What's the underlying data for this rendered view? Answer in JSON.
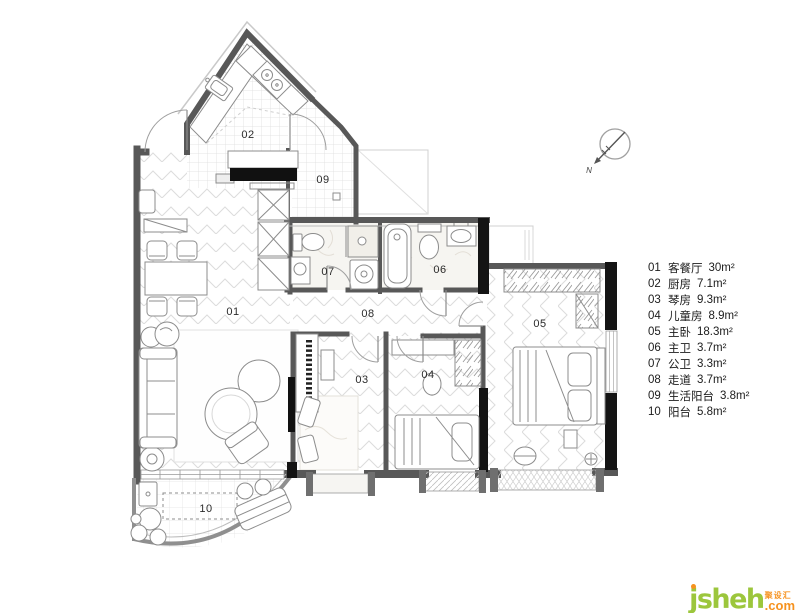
{
  "plan": {
    "labels": [
      "01",
      "02",
      "03",
      "04",
      "05",
      "06",
      "07",
      "08",
      "09",
      "10"
    ],
    "compass_north": "N"
  },
  "legend": {
    "items": [
      {
        "num": "01",
        "name": "客餐厅",
        "area": "30m²"
      },
      {
        "num": "02",
        "name": "厨房",
        "area": "7.1m²"
      },
      {
        "num": "03",
        "name": "琴房",
        "area": "9.3m²"
      },
      {
        "num": "04",
        "name": "儿童房",
        "area": "8.9m²"
      },
      {
        "num": "05",
        "name": "主卧",
        "area": "18.3m²"
      },
      {
        "num": "06",
        "name": "主卫",
        "area": "3.7m²"
      },
      {
        "num": "07",
        "name": "公卫",
        "area": "3.3m²"
      },
      {
        "num": "08",
        "name": "走道",
        "area": "3.7m²"
      },
      {
        "num": "09",
        "name": "生活阳台",
        "area": "3.8m²"
      },
      {
        "num": "10",
        "name": "阳台",
        "area": "5.8m²"
      }
    ]
  },
  "logo": {
    "brand_initial": "j",
    "brand_rest": "sheh",
    "cn": "聚设汇",
    "suffix": ".com"
  },
  "colors": {
    "logo_green": "#9cc63c",
    "logo_orange": "#f6921e",
    "wall": "#585858"
  }
}
